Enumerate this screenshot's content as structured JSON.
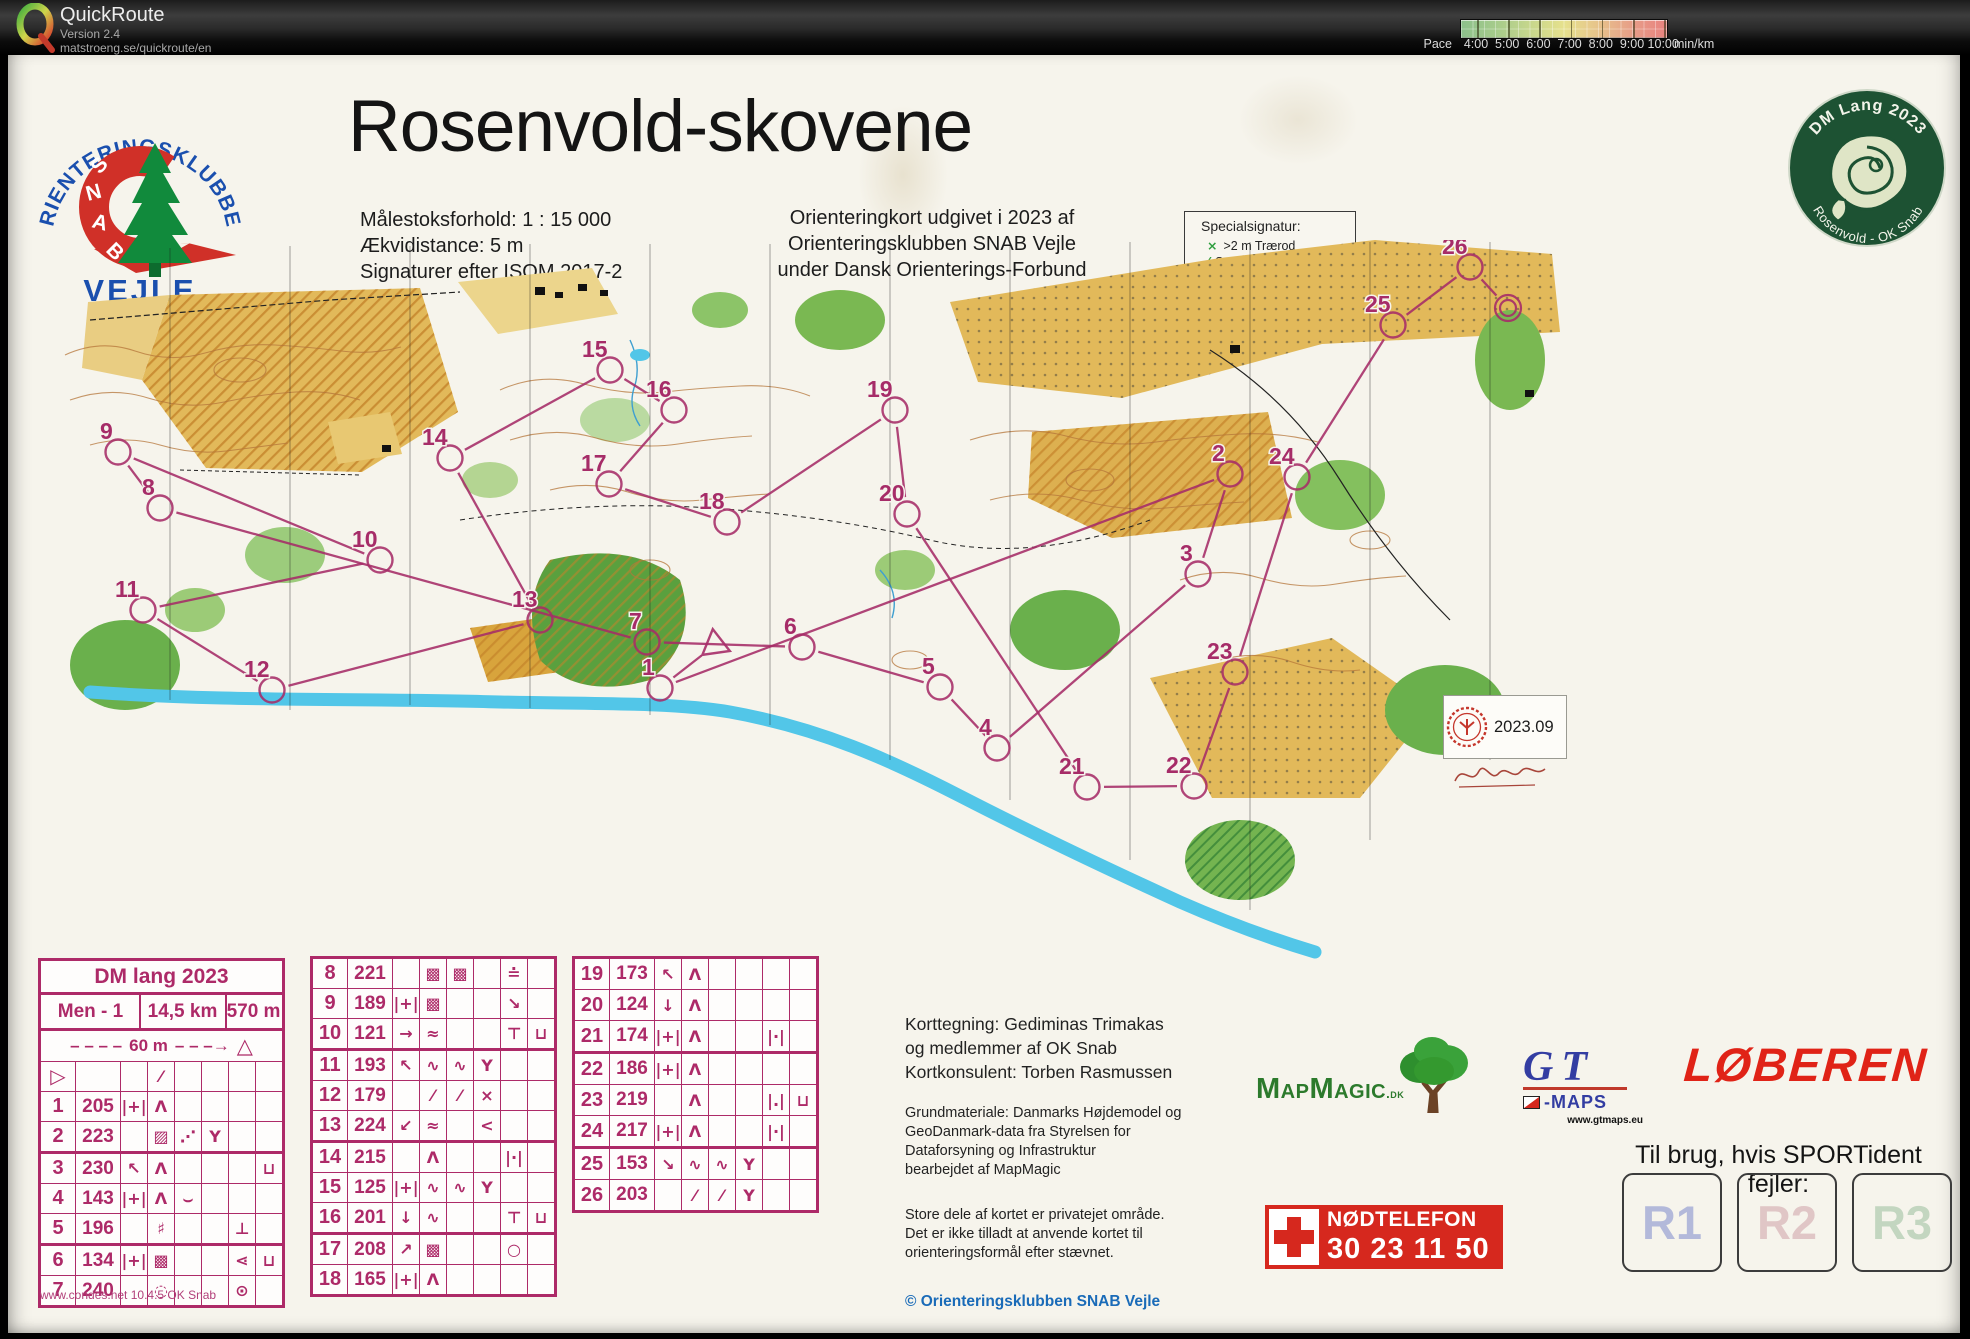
{
  "app": {
    "name": "QuickRoute",
    "version": "Version 2.4",
    "url": "matstroeng.se/quickroute/en"
  },
  "pace_legend": {
    "label": "Pace",
    "ticks": [
      "4:00",
      "5:00",
      "6:00",
      "7:00",
      "8:00",
      "9:00",
      "10:00"
    ],
    "unit": "min/km",
    "colors": [
      "#8cc08b",
      "#a5cb8b",
      "#c6d68c",
      "#e6e18d",
      "#e7c38b",
      "#e79d88",
      "#e8827f"
    ]
  },
  "header": {
    "title": "Rosenvold-skovene",
    "meta_left": [
      "Målestoksforhold:  1 : 15 000",
      "Ækvidistance: 5 m",
      "Signaturer efter ISOM 2017-2"
    ],
    "meta_right": [
      "Orienteringkort udgivet i 2023 af",
      "Orienteringsklubben SNAB Vejle",
      "under Dansk Orienterings-Forbund"
    ],
    "special_box": {
      "title": "Specialsignatur:",
      "items": [
        {
          "symbol": "×",
          "label": ">2 m Trærod"
        },
        {
          "symbol": "⁄",
          "label": "Stort væltet træ"
        }
      ]
    }
  },
  "club_logo": {
    "arc_text": "ORIENTERINGSKLUBBEN",
    "band_text": "SNAB",
    "city": "VEJLE"
  },
  "badge": {
    "top": "DM Lang 2023",
    "bottom": "Rosenvold - OK Snab"
  },
  "stamp": {
    "code": "2023.09"
  },
  "control_sheet": {
    "event": "DM lang 2023",
    "course": "Men - 1",
    "length": "14,5 km",
    "climb": "570 m",
    "funnel": {
      "dashes": "– – – –",
      "label": "60 m",
      "arrow": "– – –→",
      "symbol": "△"
    },
    "footer": "www.condes.net 10.4.5 OK Snab",
    "tables": [
      [
        {
          "n": "▷",
          "code": "",
          "sym": [
            "",
            "⁄",
            "",
            "",
            "",
            ""
          ]
        },
        {
          "n": "1",
          "code": "205",
          "sym": [
            "|+|",
            "Λ",
            "",
            "",
            "",
            ""
          ]
        },
        {
          "n": "2",
          "code": "223",
          "sym": [
            "",
            "▨",
            "⋰",
            "Y",
            "",
            ""
          ]
        },
        {
          "n": "3",
          "code": "230",
          "sym": [
            "↖",
            "Λ",
            "",
            "",
            "",
            "⊔"
          ]
        },
        {
          "n": "4",
          "code": "143",
          "sym": [
            "|+|",
            "Λ",
            "⌣",
            "",
            "",
            ""
          ]
        },
        {
          "n": "5",
          "code": "196",
          "sym": [
            "",
            "♯",
            "",
            "",
            "⊥",
            ""
          ]
        },
        {
          "n": "6",
          "code": "134",
          "sym": [
            "|+|",
            "▩",
            "",
            "",
            "⋖",
            "⊔"
          ]
        },
        {
          "n": "7",
          "code": "240",
          "sym": [
            "",
            "◌",
            "",
            "",
            "⊙",
            ""
          ]
        }
      ],
      [
        {
          "n": "8",
          "code": "221",
          "sym": [
            "",
            "▩",
            "▩",
            "",
            "≐",
            ""
          ]
        },
        {
          "n": "9",
          "code": "189",
          "sym": [
            "|+|",
            "▩",
            "",
            "",
            "↘",
            ""
          ]
        },
        {
          "n": "10",
          "code": "121",
          "sym": [
            "→",
            "≈",
            "",
            "",
            "⊤",
            "⊔"
          ]
        },
        {
          "n": "11",
          "code": "193",
          "sym": [
            "↖",
            "∿",
            "∿",
            "Y",
            "",
            ""
          ]
        },
        {
          "n": "12",
          "code": "179",
          "sym": [
            "",
            "⁄",
            "⁄",
            "×",
            "",
            ""
          ]
        },
        {
          "n": "13",
          "code": "224",
          "sym": [
            "↙",
            "≈",
            "",
            "<",
            "",
            ""
          ]
        },
        {
          "n": "14",
          "code": "215",
          "sym": [
            "",
            "Λ",
            "",
            "",
            "|·|",
            ""
          ]
        },
        {
          "n": "15",
          "code": "125",
          "sym": [
            "|+|",
            "∿",
            "∿",
            "Y",
            "",
            ""
          ]
        },
        {
          "n": "16",
          "code": "201",
          "sym": [
            "↓",
            "∿",
            "",
            "",
            "⊤",
            "⊔"
          ]
        },
        {
          "n": "17",
          "code": "208",
          "sym": [
            "↗",
            "▩",
            "",
            "",
            "○",
            ""
          ]
        },
        {
          "n": "18",
          "code": "165",
          "sym": [
            "|+|",
            "Λ",
            "",
            "",
            "",
            ""
          ]
        }
      ],
      [
        {
          "n": "19",
          "code": "173",
          "sym": [
            "↖",
            "Λ",
            "",
            "",
            "",
            ""
          ]
        },
        {
          "n": "20",
          "code": "124",
          "sym": [
            "↓",
            "Λ",
            "",
            "",
            "",
            ""
          ]
        },
        {
          "n": "21",
          "code": "174",
          "sym": [
            "|+|",
            "Λ",
            "",
            "",
            "|·|",
            ""
          ]
        },
        {
          "n": "22",
          "code": "186",
          "sym": [
            "|+|",
            "Λ",
            "",
            "",
            "",
            ""
          ]
        },
        {
          "n": "23",
          "code": "219",
          "sym": [
            "",
            "Λ",
            "",
            "",
            "|.|",
            "⊔"
          ]
        },
        {
          "n": "24",
          "code": "217",
          "sym": [
            "|+|",
            "Λ",
            "",
            "",
            "|·|",
            ""
          ]
        },
        {
          "n": "25",
          "code": "153",
          "sym": [
            "↘",
            "∿",
            "∿",
            "Y",
            "",
            ""
          ]
        },
        {
          "n": "26",
          "code": "203",
          "sym": [
            "",
            "⁄",
            "⁄",
            "Y",
            "",
            ""
          ]
        }
      ]
    ]
  },
  "credits": {
    "mapping": [
      "Korttegning: Gediminas Trimakas",
      "og medlemmer af OK Snab",
      "Kortkonsulent: Torben Rasmussen"
    ],
    "base": [
      "Grundmateriale: Danmarks Højdemodel og",
      "GeoDanmark-data fra Styrelsen for",
      "Dataforsyning og Infrastruktur",
      "bearbejdet af MapMagic"
    ],
    "notice": [
      "Store dele af kortet er privatejet område.",
      "Det er ikke tilladt at anvende kortet til",
      "orienteringsformål efter stævnet."
    ],
    "copyright": "© Orienteringsklubben SNAB Vejle"
  },
  "sponsors": {
    "mapmagic": {
      "wordmark": "MapMagic",
      "suffix": ".dk"
    },
    "gt": {
      "letters": "GT",
      "maps": "-MAPS",
      "url": "www.gtmaps.eu"
    },
    "retail": {
      "name": "LØBEREN"
    }
  },
  "emergency": {
    "title": "NØDTELEFON",
    "phone": "30 23 11 50"
  },
  "sportident": {
    "label": "Til brug, hvis SPORTident fejler:",
    "boxes": [
      {
        "label": "R1",
        "color": "#b3b9da"
      },
      {
        "label": "R2",
        "color": "#e0c6c6"
      },
      {
        "label": "R3",
        "color": "#c3d6c0"
      }
    ]
  },
  "map": {
    "color": "#a62c68",
    "start": {
      "x": 685,
      "y": 405
    },
    "finish": {
      "x": 1478,
      "y": 68
    },
    "controls": [
      {
        "n": 1,
        "x": 630,
        "y": 448
      },
      {
        "n": 2,
        "x": 1200,
        "y": 234
      },
      {
        "n": 3,
        "x": 1168,
        "y": 334
      },
      {
        "n": 4,
        "x": 967,
        "y": 508
      },
      {
        "n": 5,
        "x": 910,
        "y": 447
      },
      {
        "n": 6,
        "x": 772,
        "y": 407
      },
      {
        "n": 7,
        "x": 617,
        "y": 402
      },
      {
        "n": 8,
        "x": 130,
        "y": 268
      },
      {
        "n": 9,
        "x": 88,
        "y": 212
      },
      {
        "n": 10,
        "x": 350,
        "y": 320
      },
      {
        "n": 11,
        "x": 113,
        "y": 370
      },
      {
        "n": 12,
        "x": 242,
        "y": 450
      },
      {
        "n": 13,
        "x": 510,
        "y": 380
      },
      {
        "n": 14,
        "x": 420,
        "y": 218
      },
      {
        "n": 15,
        "x": 580,
        "y": 130
      },
      {
        "n": 16,
        "x": 644,
        "y": 170
      },
      {
        "n": 17,
        "x": 579,
        "y": 244
      },
      {
        "n": 18,
        "x": 697,
        "y": 282
      },
      {
        "n": 19,
        "x": 865,
        "y": 170
      },
      {
        "n": 20,
        "x": 877,
        "y": 274
      },
      {
        "n": 21,
        "x": 1057,
        "y": 547
      },
      {
        "n": 22,
        "x": 1164,
        "y": 546
      },
      {
        "n": 23,
        "x": 1205,
        "y": 432
      },
      {
        "n": 24,
        "x": 1267,
        "y": 237
      },
      {
        "n": 25,
        "x": 1363,
        "y": 85
      },
      {
        "n": 26,
        "x": 1440,
        "y": 27
      }
    ]
  }
}
